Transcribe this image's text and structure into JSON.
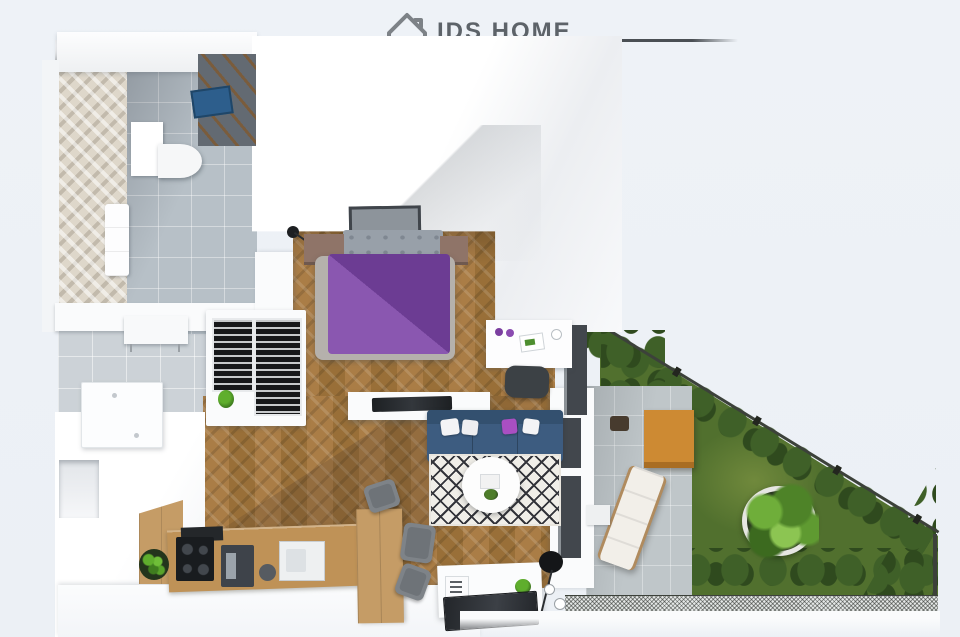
{
  "header": {
    "brand": "IDS HOME",
    "subtitle": "NIERUCHOMOŚCI",
    "house_icon": "house-outline-with-chimney-and-door"
  },
  "palette": {
    "bg": "#edf1f6",
    "logo-text": "#5d6369",
    "logo-sub": "#9aa0a6",
    "rule": "#4a4f54",
    "wall-white": "#fafbfc",
    "wood": "#aa7d46",
    "wood-dark": "#996f38",
    "tile-gray": "#b7c0c7",
    "tile-hall": "#ccd2d7",
    "herring-beige": "#ded7ca",
    "shower-dark": "#636a72",
    "shower-tray-blue": "#2d5e8c",
    "sofa-navy": "#3d5c80",
    "pillow-magenta": "#a94fc2",
    "duvet-purple": "#6c3c93",
    "duvet-purple-light": "#8a57b0",
    "bed-gray": "#98a0a9",
    "rug-line": "#33343a",
    "grass": "#51702e",
    "grass-light": "#70893c",
    "hedge": "#3f6028",
    "hedge-dark": "#2f4a1e",
    "patio": "#bfc6c9",
    "table-wood": "#cd8a33",
    "cabinet-wood": "#c59c66",
    "counter-wood": "#bf9257",
    "fence-dark": "#3c413a",
    "appliance-dark": "#42474d",
    "chair-gray": "#7e8388",
    "planter-ring": "#e6e6e2"
  },
  "scene": {
    "type": "3d-floor-plan-render",
    "rooms": [
      "bathroom",
      "bedroom",
      "wardrobe",
      "hallway",
      "living-room",
      "kitchen",
      "dining-area",
      "terrace",
      "garden"
    ],
    "objects": [
      "shower",
      "shower-tray",
      "toilet",
      "vanity",
      "double-bed",
      "purple-duvet",
      "nightstands",
      "wall-picture",
      "wall-lamp",
      "desk",
      "desk-chair",
      "wardrobe-racks",
      "tv-on-partition",
      "navy-sofa",
      "throw-pillows",
      "round-coffee-table",
      "diamond-pattern-rug",
      "kitchen-counter",
      "cooktop",
      "coffee-machine",
      "sink",
      "potted-plant",
      "tall-cabinet",
      "dining-chairs",
      "kitchen-island",
      "dark-table-top",
      "floor-lamp",
      "console-table",
      "storage-cabinet",
      "patio-table",
      "sun-lounger",
      "round-planter-tree",
      "hedges",
      "lawn",
      "mesh-fence"
    ]
  }
}
